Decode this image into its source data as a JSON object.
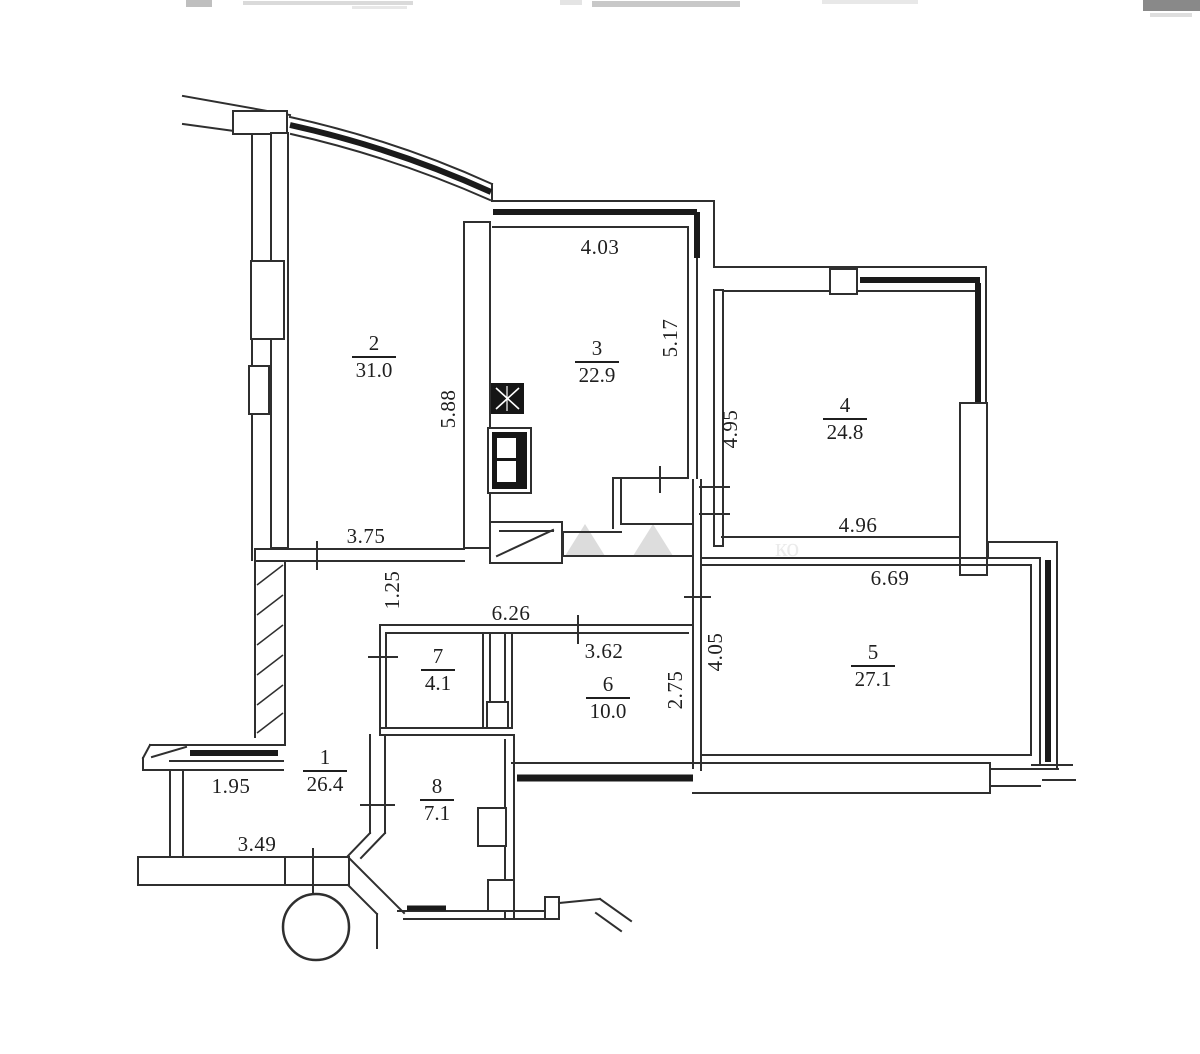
{
  "page": {
    "background": "#ffffff",
    "ink": "#2f2f2f",
    "glazing_ink": "#1a1a1a"
  },
  "rooms": [
    {
      "number": "1",
      "area": "26.4"
    },
    {
      "number": "2",
      "area": "31.0"
    },
    {
      "number": "3",
      "area": "22.9"
    },
    {
      "number": "4",
      "area": "24.8"
    },
    {
      "number": "5",
      "area": "27.1"
    },
    {
      "number": "6",
      "area": "10.0"
    },
    {
      "number": "7",
      "area": "4.1"
    },
    {
      "number": "8",
      "area": "7.1"
    }
  ],
  "dimensions": [
    {
      "value": "4.03"
    },
    {
      "value": "5.17"
    },
    {
      "value": "5.88"
    },
    {
      "value": "4.95"
    },
    {
      "value": "4.96"
    },
    {
      "value": "6.69"
    },
    {
      "value": "3.75"
    },
    {
      "value": "1.25"
    },
    {
      "value": "6.26"
    },
    {
      "value": "3.62"
    },
    {
      "value": "2.75"
    },
    {
      "value": "4.05"
    },
    {
      "value": "1.95"
    },
    {
      "value": "3.49"
    }
  ],
  "watermark": {
    "text": "ко"
  }
}
